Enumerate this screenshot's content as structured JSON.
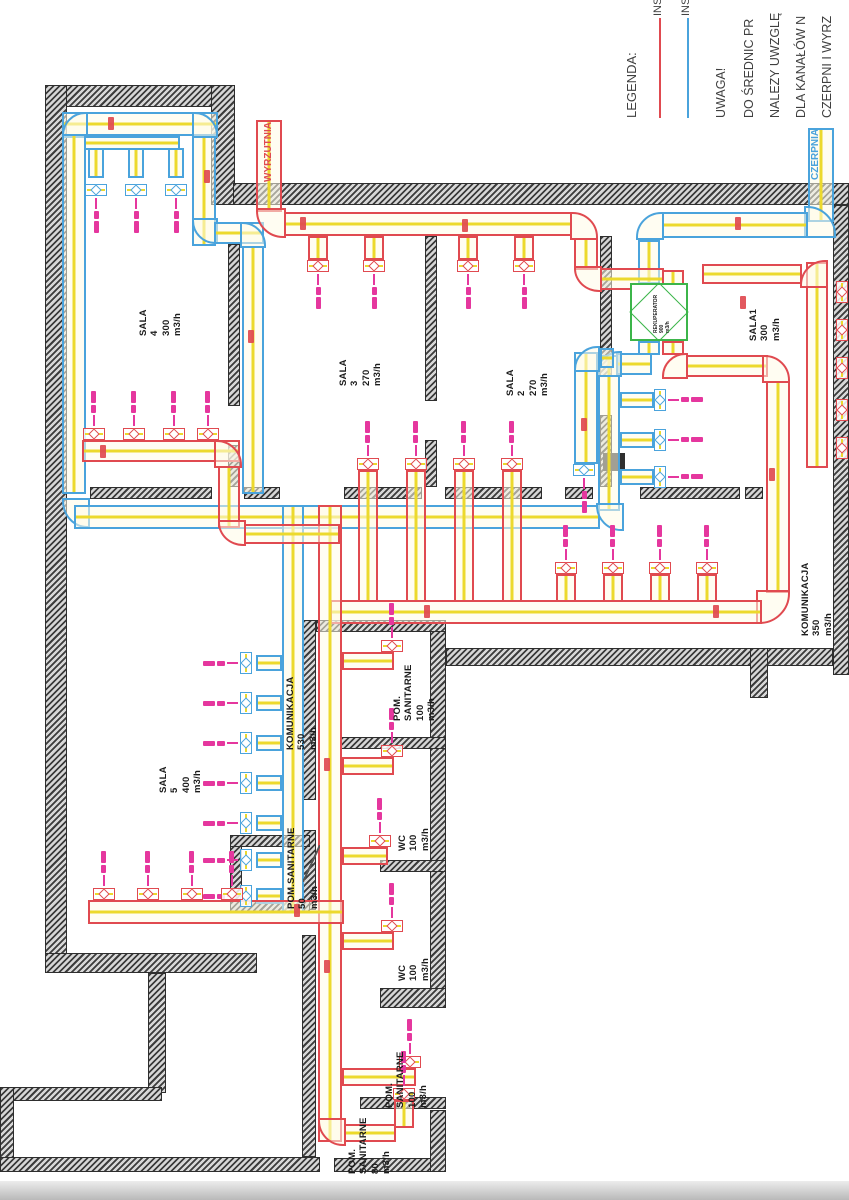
{
  "palette": {
    "supply_red": "#e04a50",
    "exhaust_blue": "#4aa3dc",
    "duct_centerline_yellow": "#ecd92c",
    "wall_hatch": "#3c3c3c",
    "diffuser_pink": "#e5379e",
    "recuperator_green": "#3cb54a",
    "label_black": "#1b1b1b",
    "note_gray": "#3f3f3f"
  },
  "legend": {
    "title": "LEGENDA:",
    "items": [
      {
        "label": "INSTA",
        "color": "#e04a50"
      },
      {
        "label": "INSTA",
        "color": "#4aa3dc"
      }
    ]
  },
  "notes": {
    "heading": "UWAGA!",
    "lines": [
      "DO ŚREDNIC PR",
      "NALEZY UWZGLĘ",
      "DLA KANAŁÓW N",
      "CZERPNI I WYRZ"
    ]
  },
  "markers": {
    "exhaust_outlet": "WYRZUTNIA",
    "intake": "CZERPNIA",
    "unit_label": "REKUPERATOR\n900\nm3/h"
  },
  "rooms": [
    {
      "label": "SALA\n4\n300\nm3/h",
      "x": 138,
      "y": 336
    },
    {
      "label": "SALA\n3\n270\nm3/h",
      "x": 338,
      "y": 386
    },
    {
      "label": "SALA\n2\n270\nm3/h",
      "x": 505,
      "y": 396
    },
    {
      "label": "SALA1\n300\nm3/h",
      "x": 748,
      "y": 341
    },
    {
      "label": "KOMUNIKACJA\n350\nm3/h",
      "x": 800,
      "y": 636
    },
    {
      "label": "SALA\n5\n400\nm3/h",
      "x": 158,
      "y": 793
    },
    {
      "label": "KOMUNIKACJA\n530\nm3/h",
      "x": 285,
      "y": 750
    },
    {
      "label": "POM.\nSANITARNE\n100\nm3/h",
      "x": 392,
      "y": 721
    },
    {
      "label": "WC\n100\nm3/h",
      "x": 397,
      "y": 851
    },
    {
      "label": "POM.SANITARNE\n50\nm3/h",
      "x": 286,
      "y": 909
    },
    {
      "label": "WC\n100\nm3/h",
      "x": 397,
      "y": 981
    },
    {
      "label": "POM.\nSANITARNE\n100\nm3/h",
      "x": 384,
      "y": 1108
    },
    {
      "label": "POM.\nSANITARNE\n80\nm3/h",
      "x": 347,
      "y": 1174
    }
  ],
  "plan": {
    "walls": [
      [
        45,
        85,
        190,
        22
      ],
      [
        211,
        85,
        24,
        120
      ],
      [
        233,
        183,
        616,
        22
      ],
      [
        45,
        85,
        22,
        888
      ],
      [
        45,
        953,
        212,
        20
      ],
      [
        148,
        973,
        18,
        120
      ],
      [
        0,
        1087,
        162,
        14
      ],
      [
        0,
        1087,
        14,
        84
      ],
      [
        0,
        1157,
        320,
        15
      ],
      [
        334,
        1158,
        112,
        14
      ],
      [
        430,
        620,
        16,
        385
      ],
      [
        380,
        988,
        66,
        20
      ],
      [
        360,
        1097,
        86,
        12
      ],
      [
        430,
        1110,
        16,
        62
      ],
      [
        833,
        205,
        16,
        470
      ],
      [
        446,
        648,
        387,
        18
      ],
      [
        750,
        648,
        18,
        50
      ],
      [
        90,
        487,
        122,
        12
      ],
      [
        244,
        487,
        36,
        12
      ],
      [
        344,
        487,
        78,
        12
      ],
      [
        445,
        487,
        97,
        12
      ],
      [
        565,
        487,
        28,
        12
      ],
      [
        640,
        487,
        100,
        12
      ],
      [
        745,
        487,
        18,
        12
      ],
      [
        228,
        244,
        12,
        162
      ],
      [
        228,
        445,
        12,
        42
      ],
      [
        425,
        236,
        12,
        165
      ],
      [
        425,
        440,
        12,
        47
      ],
      [
        600,
        236,
        12,
        140
      ],
      [
        600,
        415,
        12,
        72
      ],
      [
        316,
        620,
        130,
        12
      ],
      [
        340,
        737,
        106,
        12
      ],
      [
        380,
        860,
        66,
        12
      ],
      [
        302,
        620,
        14,
        180
      ],
      [
        302,
        830,
        14,
        80
      ],
      [
        302,
        935,
        14,
        222
      ],
      [
        230,
        835,
        12,
        78
      ],
      [
        230,
        835,
        80,
        12
      ],
      [
        230,
        901,
        80,
        12
      ]
    ],
    "blocks": [
      [
        603,
        453,
        22,
        18
      ]
    ],
    "ducts": [
      [
        62,
        112,
        156,
        24,
        "b",
        "h"
      ],
      [
        62,
        112,
        26,
        26,
        "b",
        "e",
        "ctl"
      ],
      [
        192,
        112,
        26,
        26,
        "b",
        "e",
        "ctr"
      ],
      [
        62,
        134,
        24,
        360,
        "b",
        "v"
      ],
      [
        192,
        136,
        24,
        110,
        "b",
        "v"
      ],
      [
        192,
        218,
        26,
        26,
        "b",
        "e",
        "cbl"
      ],
      [
        214,
        222,
        50,
        22,
        "b",
        "h"
      ],
      [
        240,
        222,
        26,
        26,
        "b",
        "e",
        "ctr"
      ],
      [
        242,
        246,
        22,
        248,
        "b",
        "v"
      ],
      [
        84,
        136,
        96,
        14,
        "b",
        "h"
      ],
      [
        88,
        148,
        16,
        30,
        "b",
        "v"
      ],
      [
        128,
        148,
        16,
        30,
        "b",
        "v"
      ],
      [
        168,
        148,
        16,
        30,
        "b",
        "v"
      ],
      [
        62,
        498,
        28,
        30,
        "b",
        "e",
        "cbl"
      ],
      [
        74,
        505,
        526,
        24,
        "b",
        "h"
      ],
      [
        598,
        355,
        22,
        156,
        "b",
        "v"
      ],
      [
        596,
        503,
        28,
        28,
        "b",
        "e",
        "cbl"
      ],
      [
        638,
        341,
        22,
        14,
        "b",
        "v"
      ],
      [
        616,
        353,
        36,
        22,
        "b",
        "h"
      ],
      [
        596,
        351,
        26,
        26,
        "b",
        "e",
        "ctl"
      ],
      [
        620,
        392,
        34,
        16,
        "b",
        "h"
      ],
      [
        620,
        432,
        34,
        16,
        "b",
        "h"
      ],
      [
        620,
        469,
        34,
        16,
        "b",
        "h"
      ],
      [
        808,
        128,
        26,
        94,
        "b",
        "v"
      ],
      [
        804,
        206,
        32,
        32,
        "b",
        "e",
        "ctr"
      ],
      [
        662,
        212,
        146,
        26,
        "b",
        "h"
      ],
      [
        636,
        212,
        28,
        28,
        "b",
        "e",
        "ctl"
      ],
      [
        638,
        240,
        22,
        44,
        "b",
        "v"
      ],
      [
        574,
        352,
        24,
        112,
        "b",
        "v"
      ],
      [
        574,
        346,
        26,
        26,
        "b",
        "e",
        "ctl"
      ],
      [
        600,
        348,
        14,
        20,
        "b",
        "h"
      ],
      [
        282,
        505,
        22,
        408,
        "b",
        "v"
      ],
      [
        256,
        655,
        26,
        16,
        "b",
        "h"
      ],
      [
        256,
        695,
        26,
        16,
        "b",
        "h"
      ],
      [
        256,
        735,
        26,
        16,
        "b",
        "h"
      ],
      [
        256,
        775,
        26,
        16,
        "b",
        "h"
      ],
      [
        256,
        815,
        26,
        16,
        "b",
        "h"
      ],
      [
        256,
        852,
        26,
        16,
        "b",
        "h"
      ],
      [
        256,
        888,
        26,
        16,
        "b",
        "h"
      ],
      [
        256,
        120,
        26,
        92,
        "r",
        "v"
      ],
      [
        256,
        208,
        30,
        30,
        "r",
        "e",
        "cbl"
      ],
      [
        284,
        212,
        288,
        24,
        "r",
        "h"
      ],
      [
        570,
        212,
        28,
        28,
        "r",
        "e",
        "ctr"
      ],
      [
        574,
        238,
        24,
        32,
        "r",
        "v"
      ],
      [
        574,
        266,
        28,
        26,
        "r",
        "e",
        "cbl"
      ],
      [
        600,
        268,
        64,
        22,
        "r",
        "h"
      ],
      [
        662,
        270,
        22,
        15,
        "r",
        "v"
      ],
      [
        662,
        341,
        22,
        14,
        "r",
        "v"
      ],
      [
        662,
        353,
        26,
        26,
        "r",
        "e",
        "ctl"
      ],
      [
        686,
        355,
        82,
        22,
        "r",
        "h"
      ],
      [
        762,
        355,
        28,
        28,
        "r",
        "e",
        "ctr"
      ],
      [
        766,
        381,
        24,
        212,
        "r",
        "v"
      ],
      [
        756,
        590,
        34,
        34,
        "r",
        "e",
        "cbr"
      ],
      [
        330,
        600,
        432,
        24,
        "r",
        "h"
      ],
      [
        806,
        262,
        22,
        206,
        "r",
        "v"
      ],
      [
        800,
        260,
        28,
        28,
        "r",
        "e",
        "ctl"
      ],
      [
        702,
        264,
        100,
        20,
        "r",
        "h"
      ],
      [
        318,
        505,
        24,
        637,
        "r",
        "v"
      ],
      [
        318,
        1118,
        28,
        28,
        "r",
        "e",
        "cbl"
      ],
      [
        344,
        1124,
        52,
        18,
        "r",
        "h"
      ],
      [
        394,
        1100,
        20,
        28,
        "r",
        "v"
      ],
      [
        88,
        900,
        256,
        24,
        "r",
        "h"
      ],
      [
        82,
        440,
        158,
        22,
        "r",
        "h"
      ],
      [
        214,
        440,
        28,
        28,
        "r",
        "e",
        "ctr"
      ],
      [
        218,
        466,
        22,
        62,
        "r",
        "v"
      ],
      [
        218,
        520,
        28,
        26,
        "r",
        "e",
        "cbl"
      ],
      [
        244,
        524,
        96,
        20,
        "r",
        "h"
      ],
      [
        342,
        652,
        52,
        18,
        "r",
        "h"
      ],
      [
        342,
        757,
        52,
        18,
        "r",
        "h"
      ],
      [
        342,
        847,
        46,
        18,
        "r",
        "h"
      ],
      [
        342,
        932,
        52,
        18,
        "r",
        "h"
      ],
      [
        342,
        1068,
        74,
        18,
        "r",
        "h"
      ],
      [
        358,
        470,
        20,
        132,
        "r",
        "v"
      ],
      [
        406,
        470,
        20,
        132,
        "r",
        "v"
      ],
      [
        454,
        470,
        20,
        132,
        "r",
        "v"
      ],
      [
        502,
        470,
        20,
        132,
        "r",
        "v"
      ],
      [
        556,
        574,
        20,
        28,
        "r",
        "v"
      ],
      [
        603,
        574,
        20,
        28,
        "r",
        "v"
      ],
      [
        650,
        574,
        20,
        28,
        "r",
        "v"
      ],
      [
        697,
        574,
        20,
        28,
        "r",
        "v"
      ],
      [
        308,
        236,
        20,
        24,
        "r",
        "v"
      ],
      [
        364,
        236,
        20,
        24,
        "r",
        "v"
      ],
      [
        458,
        236,
        20,
        24,
        "r",
        "v"
      ],
      [
        514,
        236,
        20,
        24,
        "r",
        "v"
      ]
    ],
    "diffusers": [
      [
        96,
        184,
        "down",
        "b"
      ],
      [
        136,
        184,
        "down",
        "b"
      ],
      [
        176,
        184,
        "down",
        "b"
      ],
      [
        584,
        464,
        "down",
        "b"
      ],
      [
        654,
        400,
        "right",
        "b"
      ],
      [
        654,
        440,
        "right",
        "b"
      ],
      [
        654,
        477,
        "right",
        "b"
      ],
      [
        252,
        663,
        "left",
        "b"
      ],
      [
        252,
        703,
        "left",
        "b"
      ],
      [
        252,
        743,
        "left",
        "b"
      ],
      [
        252,
        783,
        "left",
        "b"
      ],
      [
        252,
        823,
        "left",
        "b"
      ],
      [
        252,
        860,
        "left",
        "b"
      ],
      [
        252,
        896,
        "left",
        "b"
      ],
      [
        318,
        260,
        "down",
        "r"
      ],
      [
        374,
        260,
        "down",
        "r"
      ],
      [
        468,
        260,
        "down",
        "r"
      ],
      [
        524,
        260,
        "down",
        "r"
      ],
      [
        94,
        440,
        "up",
        "r"
      ],
      [
        134,
        440,
        "up",
        "r"
      ],
      [
        174,
        440,
        "up",
        "r"
      ],
      [
        208,
        440,
        "up",
        "r"
      ],
      [
        104,
        900,
        "up",
        "r"
      ],
      [
        148,
        900,
        "up",
        "r"
      ],
      [
        192,
        900,
        "up",
        "r"
      ],
      [
        232,
        900,
        "up",
        "r"
      ],
      [
        368,
        470,
        "up",
        "r"
      ],
      [
        416,
        470,
        "up",
        "r"
      ],
      [
        464,
        470,
        "up",
        "r"
      ],
      [
        512,
        470,
        "up",
        "r"
      ],
      [
        566,
        574,
        "up",
        "r"
      ],
      [
        613,
        574,
        "up",
        "r"
      ],
      [
        660,
        574,
        "up",
        "r"
      ],
      [
        707,
        574,
        "up",
        "r"
      ],
      [
        392,
        652,
        "up",
        "r"
      ],
      [
        392,
        757,
        "up",
        "r"
      ],
      [
        380,
        847,
        "up",
        "r"
      ],
      [
        392,
        932,
        "up",
        "r"
      ],
      [
        410,
        1068,
        "up",
        "r"
      ],
      [
        404,
        1100,
        "up",
        "r"
      ],
      [
        836,
        292,
        "right",
        "r"
      ],
      [
        836,
        330,
        "right",
        "r"
      ],
      [
        836,
        368,
        "right",
        "r"
      ],
      [
        836,
        410,
        "right",
        "r"
      ],
      [
        836,
        448,
        "right",
        "r"
      ]
    ],
    "tags": [
      [
        300,
        217
      ],
      [
        462,
        219
      ],
      [
        108,
        117
      ],
      [
        204,
        170
      ],
      [
        248,
        330
      ],
      [
        581,
        418
      ],
      [
        740,
        296
      ],
      [
        713,
        605
      ],
      [
        424,
        605
      ],
      [
        324,
        758
      ],
      [
        324,
        960
      ],
      [
        100,
        445
      ],
      [
        294,
        904
      ],
      [
        735,
        217
      ],
      [
        769,
        468
      ]
    ],
    "doors": [
      [
        303,
        845,
        17,
        37
      ]
    ]
  }
}
